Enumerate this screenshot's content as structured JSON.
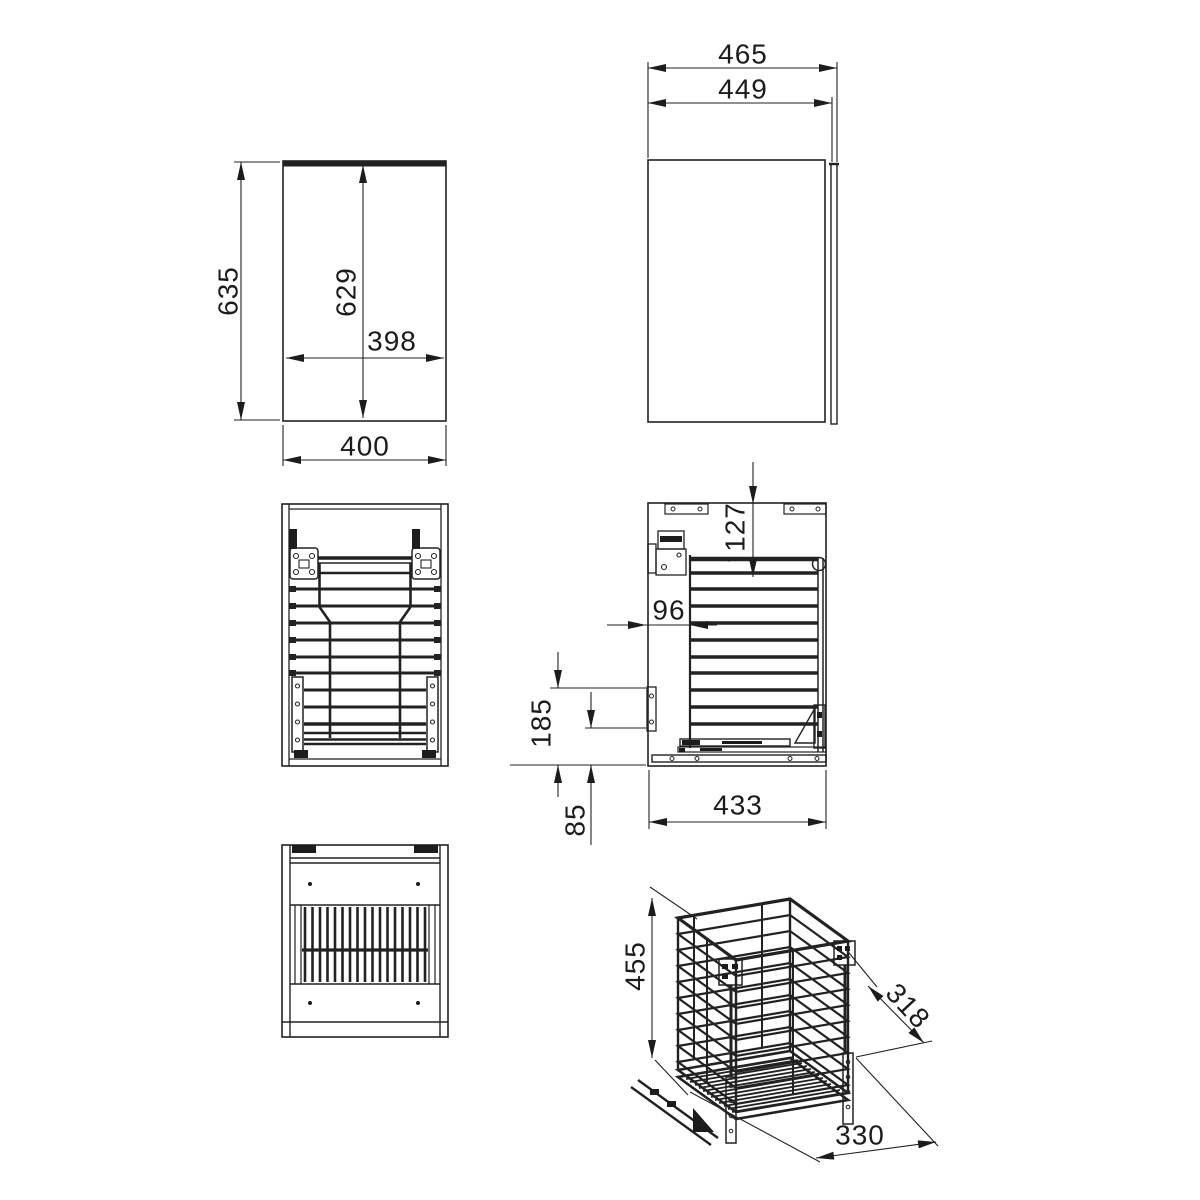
{
  "dims": {
    "front": {
      "height_overall": "635",
      "height_inner": "629",
      "width_inner": "398",
      "width_overall": "400"
    },
    "top": {
      "depth_overall": "465",
      "depth_body": "449"
    },
    "side": {
      "offset_top": "127",
      "offset_front": "96",
      "rail_height": "185",
      "offset_bottom": "85",
      "depth_inner": "433"
    },
    "iso": {
      "basket_height": "455",
      "basket_depth": "318",
      "basket_width": "330"
    }
  },
  "colors": {
    "line": "#222222",
    "background": "#ffffff"
  }
}
